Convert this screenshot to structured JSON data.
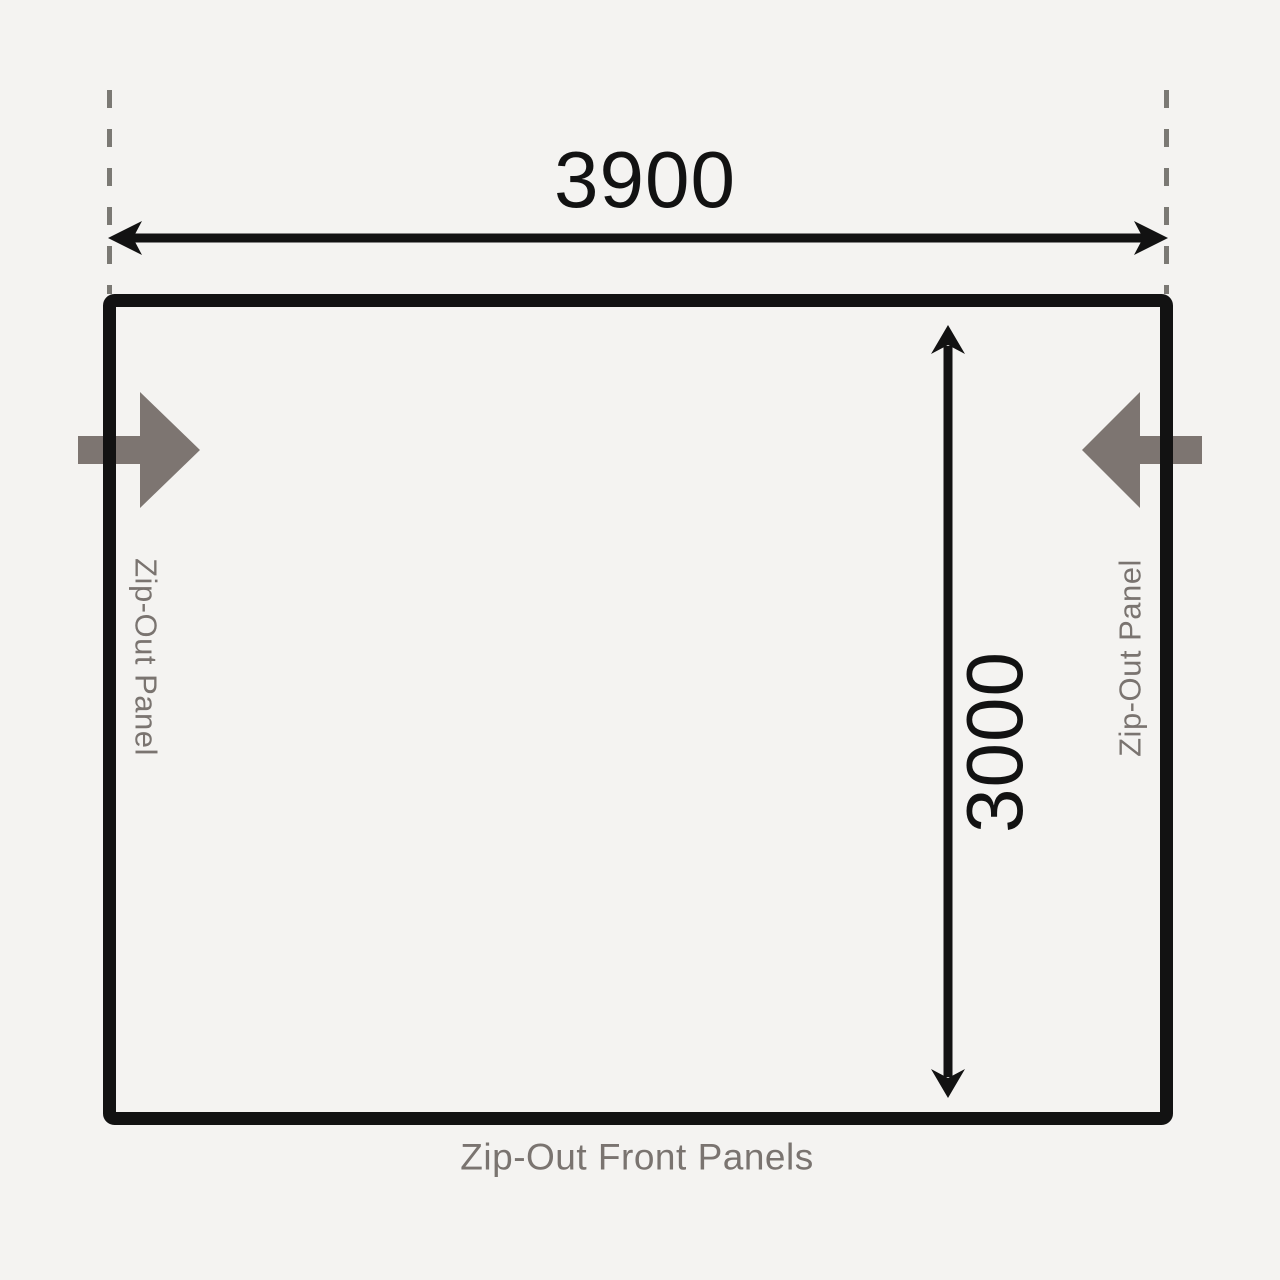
{
  "diagram": {
    "width_dimension": "3900",
    "depth_dimension": "3000",
    "left_panel_label": "Zip-Out Panel",
    "right_panel_label": "Zip-Out Panel",
    "front_panel_label": "Zip-Out Front Panels",
    "icons": {
      "left_wall": "zip-out-arrow-right-icon",
      "right_wall": "zip-out-arrow-left-icon"
    },
    "colors": {
      "background": "#f4f3f1",
      "line": "#121212",
      "dashed_line": "#7b7974",
      "zip_arrow": "#7d7571",
      "label_text": "#7a7470"
    }
  }
}
